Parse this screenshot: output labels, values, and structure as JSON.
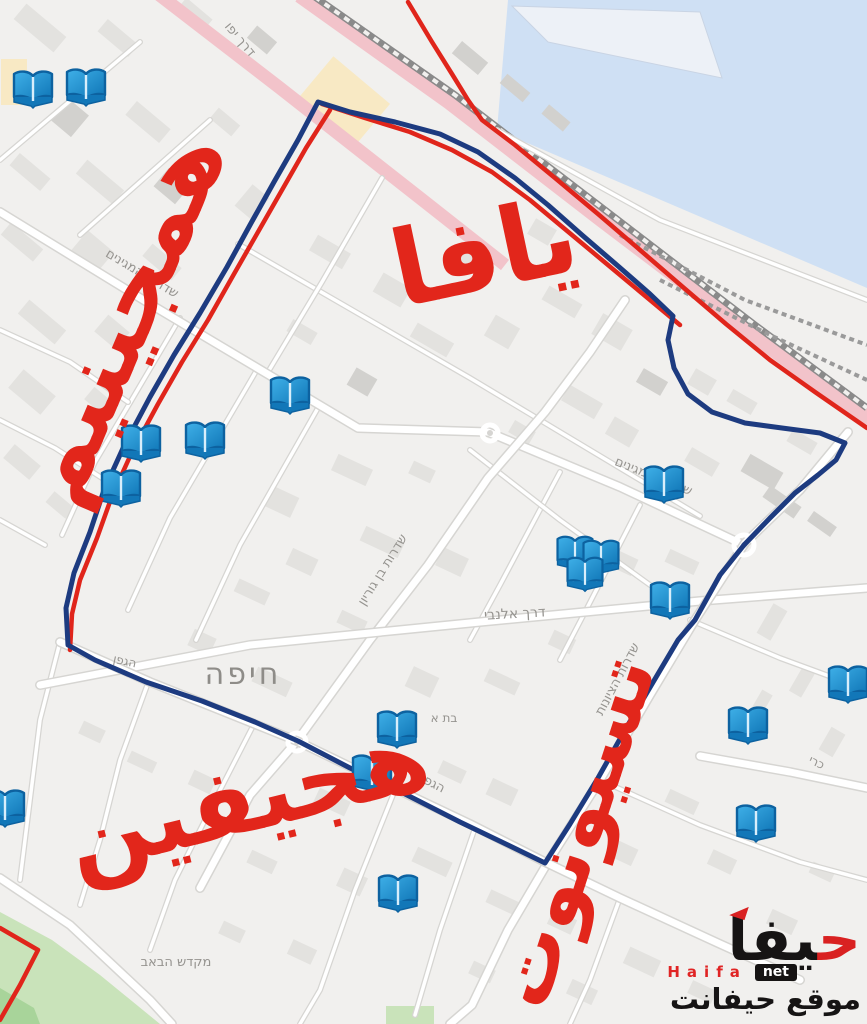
{
  "map": {
    "city_label": {
      "text": "חיפה",
      "x": 243,
      "y": 684,
      "rotate": 0,
      "size": 30
    },
    "street_labels": [
      {
        "id": "derech-yafo",
        "text": "דרך יפו",
        "x": 237,
        "y": 42,
        "rotate": 50,
        "size": 13
      },
      {
        "id": "meginim-upper",
        "text": "שדרות המגינים",
        "x": 140,
        "y": 277,
        "rotate": 31,
        "size": 13
      },
      {
        "id": "meginim-mid",
        "text": "שדרות המגינים",
        "x": 652,
        "y": 480,
        "rotate": 22,
        "size": 13
      },
      {
        "id": "ben-gurion",
        "text": "שדרות בן גוריון",
        "x": 386,
        "y": 572,
        "rotate": -58,
        "size": 13
      },
      {
        "id": "allenby",
        "text": "דרך אלנבי",
        "x": 515,
        "y": 618,
        "rotate": -3,
        "size": 14
      },
      {
        "id": "tsionut-street",
        "text": "שדרות הציונות",
        "x": 621,
        "y": 681,
        "rotate": -62,
        "size": 13
      },
      {
        "id": "hagefen-west",
        "text": "הגפן",
        "x": 124,
        "y": 665,
        "rotate": 12,
        "size": 12
      },
      {
        "id": "hagefen-mid",
        "text": "הגפן",
        "x": 431,
        "y": 787,
        "rotate": 27,
        "size": 13
      },
      {
        "id": "beit-a",
        "text": "בת א",
        "x": 444,
        "y": 722,
        "rotate": 0,
        "size": 12
      },
      {
        "id": "kari",
        "text": "כרי",
        "x": 815,
        "y": 766,
        "rotate": 25,
        "size": 12
      },
      {
        "id": "mikdash-habab",
        "text": "מקדש הבאב",
        "x": 176,
        "y": 966,
        "rotate": 0,
        "size": 13
      }
    ],
    "red_annotations": [
      {
        "id": "yafa",
        "text": "يافا",
        "x": 492,
        "y": 288,
        "rotate": -12,
        "size": 105
      },
      {
        "id": "meginim-ar",
        "text": "همجينيم",
        "x": 150,
        "y": 330,
        "rotate": -67,
        "size": 96
      },
      {
        "id": "hagefen-ar",
        "text": "هجيفين",
        "x": 255,
        "y": 830,
        "rotate": -14,
        "size": 96
      },
      {
        "id": "tsionut-ar",
        "text": "تسيونوت",
        "x": 600,
        "y": 840,
        "rotate": -72,
        "size": 82
      }
    ],
    "routes": {
      "blue_route": {
        "color": "#1d3b80",
        "width": 5,
        "points": "318,102 350,112 395,122 440,134 478,152 515,178 548,205 582,235 618,266 650,294 673,316 668,340 674,368 688,394 712,412 745,423 782,428 820,433 845,443 836,460 818,475 795,493 770,518 744,545 720,575 695,620 678,640 652,684 625,730 598,778 570,824 545,863 510,846 460,822 405,794 350,768 298,741 255,722 202,701 146,682 95,660 68,645 66,608 74,573 90,532 104,490 124,446 150,397 174,355 200,313 227,267 250,225 274,182 298,140 318,102"
      },
      "red_color": "#e0251b",
      "red_width": 4.5,
      "red_lines": [
        {
          "id": "boundary-west",
          "points": "330,110 306,148 282,190 258,232 234,274 208,320 182,362 158,404 132,452 112,496 97,538 80,580 72,614 70,650"
        },
        {
          "id": "boundary-north",
          "points": "408,2 432,42 452,74 468,100 482,120 515,145 555,178 598,214 640,250 684,288 726,324 770,360 815,392 867,428"
        },
        {
          "id": "boundary-rail",
          "points": "322,104 365,118 410,132 452,150 492,172 530,200 566,230 602,260 638,290 668,315 680,325"
        },
        {
          "id": "boundary-bahai",
          "points": "0,928 38,950 20,985 0,1020"
        }
      ]
    },
    "book_markers": {
      "meaning": "open-book map marker",
      "color_main": "#1789cb",
      "color_dark": "#0d62a0",
      "color_light": "#3fb0e8",
      "positions": [
        [
          33,
          87,
          1
        ],
        [
          86,
          85,
          1
        ],
        [
          290,
          393,
          1
        ],
        [
          141,
          441,
          1
        ],
        [
          205,
          438,
          1
        ],
        [
          121,
          486,
          1
        ],
        [
          664,
          482,
          1
        ],
        [
          575,
          551,
          0.92
        ],
        [
          601,
          555,
          0.92
        ],
        [
          585,
          572,
          0.92
        ],
        [
          670,
          598,
          1
        ],
        [
          848,
          682,
          1
        ],
        [
          748,
          723,
          1
        ],
        [
          756,
          821,
          1
        ],
        [
          397,
          727,
          1
        ],
        [
          372,
          771,
          1
        ],
        [
          398,
          891,
          1
        ],
        [
          5,
          806,
          1
        ]
      ]
    },
    "colors": {
      "land": "#f1f0ee",
      "water": "#cfe0f4",
      "quay": "#edf1f7",
      "green": "#c9e3ba",
      "green_dark": "#a8d49a",
      "pink_road": "#f2c3ca",
      "railway": "#8a8a8a",
      "building": "#e3e2df",
      "building_dark": "#d2d1ce",
      "building_beige": "#f8e9c4",
      "road_fill": "#ffffff",
      "road_casing": "#d6d5d2",
      "label_gray": "#95938f"
    }
  },
  "watermark": {
    "brand_initial": "ح",
    "brand_rest": "يفا",
    "brand_latin": "Haifa",
    "brand_net": "net",
    "tagline": "موقع حيفانت"
  }
}
